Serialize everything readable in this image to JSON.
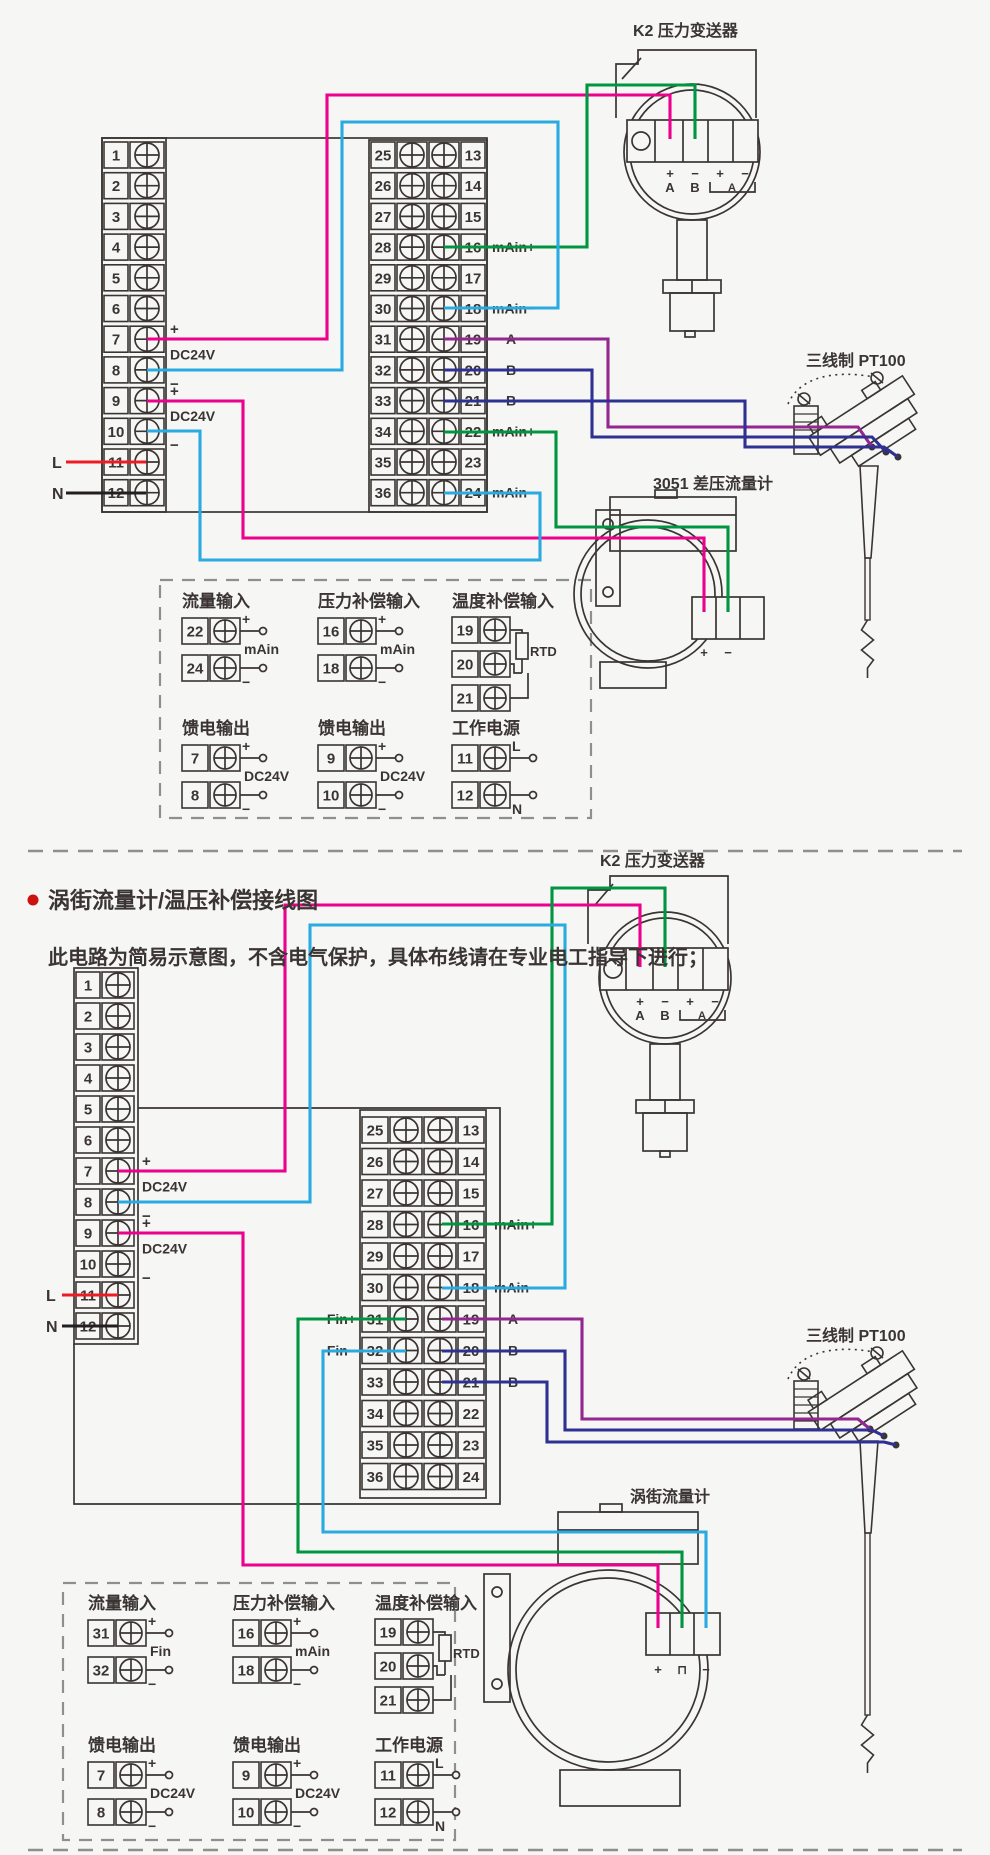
{
  "colors": {
    "line": "#3a3532",
    "magenta": "#ec008c",
    "green": "#009540",
    "cyan": "#29abe2",
    "purple": "#93268f",
    "blue": "#2e3192",
    "red": "#ed1c24",
    "black": "#231f20",
    "dash": "#8f8f8f",
    "bullet": "#cc1111",
    "bg": "#f6f6f4"
  },
  "header": {
    "title": "涡街流量计/温压补偿接线图",
    "subtitle": "此电路为简易示意图，不含电气保护，具体布线请在专业电工指导下进行；"
  },
  "terminal_numbers": {
    "left": [
      "1",
      "2",
      "3",
      "4",
      "5",
      "6",
      "7",
      "8",
      "9",
      "10",
      "11",
      "12"
    ],
    "right_outer": [
      "25",
      "26",
      "27",
      "28",
      "29",
      "30",
      "31",
      "32",
      "33",
      "34",
      "35",
      "36"
    ],
    "right_inner": [
      "13",
      "14",
      "15",
      "16",
      "17",
      "18",
      "19",
      "20",
      "21",
      "22",
      "23",
      "24"
    ]
  },
  "top": {
    "k2": {
      "label": "K2 压力变送器",
      "marks": [
        "+",
        "−",
        "+",
        "−"
      ],
      "subs": [
        "A",
        "B"
      ],
      "bracket_sub": "A"
    },
    "meter": {
      "label": "3051 差压流量计",
      "marks": [
        "+",
        "−"
      ]
    },
    "pt100": {
      "label": "三线制 PT100"
    },
    "left_annotations": {
      "pairs": [
        {
          "plus": "+",
          "mid": "DC24V",
          "minus": "−"
        },
        {
          "plus": "+",
          "mid": "DC24V",
          "minus": "−"
        }
      ],
      "l": "L",
      "n": "N"
    },
    "right_labels": [
      {
        "row": 16,
        "text": "mAin+"
      },
      {
        "row": 18,
        "text": "mAin−"
      },
      {
        "row": 19,
        "text": "A"
      },
      {
        "row": 20,
        "text": "B"
      },
      {
        "row": 21,
        "text": "B"
      },
      {
        "row": 22,
        "text": "mAin+"
      },
      {
        "row": 24,
        "text": "mAin−"
      }
    ],
    "left_labels": [],
    "legend": [
      {
        "title": "流量输入",
        "rows": [
          {
            "num": "22",
            "tag": "+"
          },
          {
            "num": "24",
            "tag": "−"
          }
        ],
        "mid": "mAin"
      },
      {
        "title": "压力补偿输入",
        "rows": [
          {
            "num": "16",
            "tag": "+"
          },
          {
            "num": "18",
            "tag": "−"
          }
        ],
        "mid": "mAin"
      },
      {
        "title": "温度补偿输入",
        "rows": [
          {
            "num": "19"
          },
          {
            "num": "20"
          },
          {
            "num": "21"
          }
        ],
        "rtd": "RTD"
      },
      {
        "title": "馈电输出",
        "rows": [
          {
            "num": "7",
            "tag": "+"
          },
          {
            "num": "8",
            "tag": "−"
          }
        ],
        "mid": "DC24V"
      },
      {
        "title": "馈电输出",
        "rows": [
          {
            "num": "9",
            "tag": "+"
          },
          {
            "num": "10",
            "tag": "−"
          }
        ],
        "mid": "DC24V"
      },
      {
        "title": "工作电源",
        "rows": [
          {
            "num": "11",
            "tag": "L"
          },
          {
            "num": "12",
            "tag": "N"
          }
        ]
      }
    ]
  },
  "bottom": {
    "k2": {
      "label": "K2 压力变送器",
      "marks": [
        "+",
        "−",
        "+",
        "−"
      ],
      "subs": [
        "A",
        "B"
      ],
      "bracket_sub": "A"
    },
    "meter": {
      "label": "涡街流量计",
      "marks": [
        "+",
        "⊓",
        "−"
      ]
    },
    "pt100": {
      "label": "三线制 PT100"
    },
    "left_annotations": {
      "pairs": [
        {
          "plus": "+",
          "mid": "DC24V",
          "minus": "−"
        },
        {
          "plus": "+",
          "mid": "DC24V",
          "minus": "−"
        }
      ],
      "l": "L",
      "n": "N"
    },
    "right_labels": [
      {
        "row": 16,
        "text": "mAin+"
      },
      {
        "row": 18,
        "text": "mAin−"
      },
      {
        "row": 19,
        "text": "A"
      },
      {
        "row": 20,
        "text": "B"
      },
      {
        "row": 21,
        "text": "B"
      }
    ],
    "left_labels": [
      {
        "row": 31,
        "text": "Fin+"
      },
      {
        "row": 32,
        "text": "Fin−"
      }
    ],
    "legend": [
      {
        "title": "流量输入",
        "rows": [
          {
            "num": "31",
            "tag": "+"
          },
          {
            "num": "32",
            "tag": "−"
          }
        ],
        "mid": "Fin"
      },
      {
        "title": "压力补偿输入",
        "rows": [
          {
            "num": "16",
            "tag": "+"
          },
          {
            "num": "18",
            "tag": "−"
          }
        ],
        "mid": "mAin"
      },
      {
        "title": "温度补偿输入",
        "rows": [
          {
            "num": "19"
          },
          {
            "num": "20"
          },
          {
            "num": "21"
          }
        ],
        "rtd": "RTD"
      },
      {
        "title": "馈电输出",
        "rows": [
          {
            "num": "7",
            "tag": "+"
          },
          {
            "num": "8",
            "tag": "−"
          }
        ],
        "mid": "DC24V"
      },
      {
        "title": "馈电输出",
        "rows": [
          {
            "num": "9",
            "tag": "+"
          },
          {
            "num": "10",
            "tag": "−"
          }
        ],
        "mid": "DC24V"
      },
      {
        "title": "工作电源",
        "rows": [
          {
            "num": "11",
            "tag": "L"
          },
          {
            "num": "12",
            "tag": "N"
          }
        ]
      }
    ]
  }
}
